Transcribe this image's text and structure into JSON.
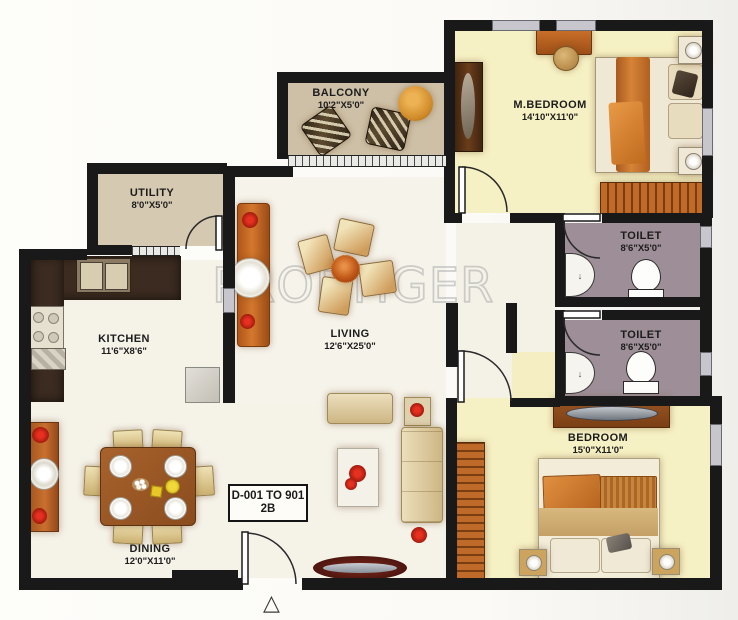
{
  "watermark": "PROPTIGER",
  "icons": {
    "north_arrow": "△"
  },
  "unit_label": {
    "line1": "D-001 TO 901",
    "line2": "2B"
  },
  "rooms": [
    {
      "name": "BALCONY",
      "dims": "10'2\"X5'0\""
    },
    {
      "name": "M.BEDROOM",
      "dims": "14'10\"X11'0\""
    },
    {
      "name": "UTILITY",
      "dims": "8'0\"X5'0\""
    },
    {
      "name": "TOILET",
      "dims": "8'6\"X5'0\""
    },
    {
      "name": "TOILET",
      "dims": "8'6\"X5'0\""
    },
    {
      "name": "KITCHEN",
      "dims": "11'6\"X8'6\""
    },
    {
      "name": "LIVING",
      "dims": "12'6\"X25'0\""
    },
    {
      "name": "BEDROOM",
      "dims": "15'0\"X11'0\""
    },
    {
      "name": "DINING",
      "dims": "12'0\"X11'0\""
    }
  ],
  "colors": {
    "wall": "#191919",
    "bedroom_floor": "#f6f1c4",
    "balcony_floor": "#cec0a6",
    "utility_floor": "#d6c9b1",
    "toilet_floor": "#9d8e97",
    "main_floor": "#f5f2e8",
    "furniture_orange": "#c4692a",
    "wood_brown": "#9c5a28",
    "counter_dark": "#3a2a20",
    "watermark_gray": "#b5b5b5"
  }
}
